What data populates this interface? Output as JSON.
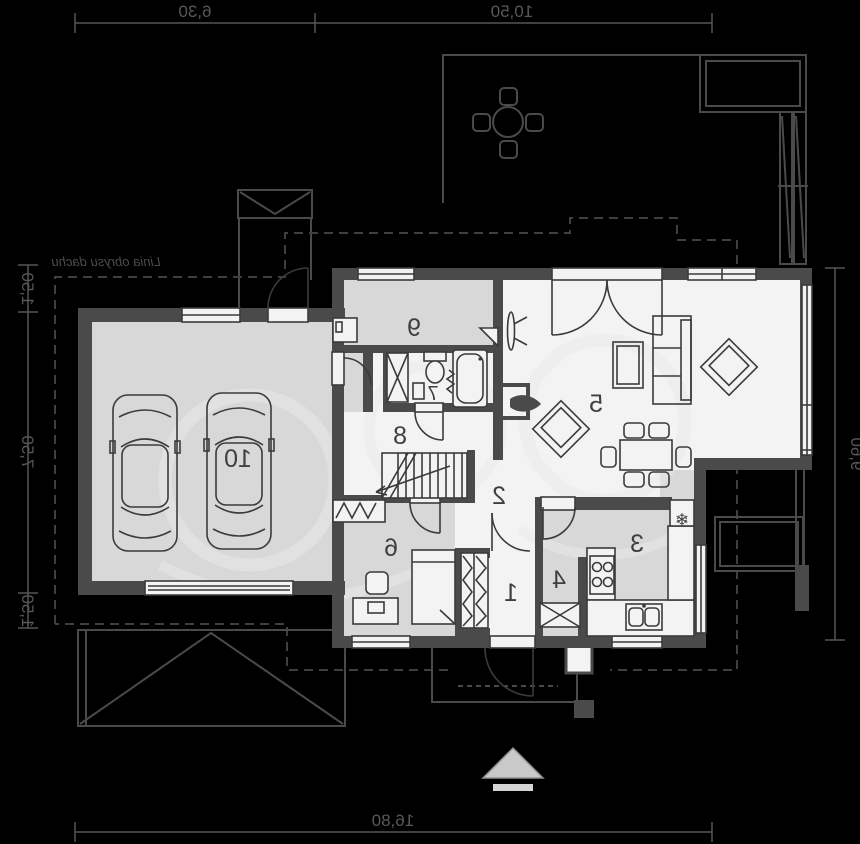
{
  "dimensions": {
    "top_a": "6,30",
    "top_b": "10,50",
    "bottom_total": "16,80",
    "right_total": "9,60",
    "left_a": "1,50",
    "left_b": "7,50",
    "left_c": "1,50"
  },
  "labels": {
    "roof_outline": "Linia obrysu dachu"
  },
  "rooms": {
    "r1": "1",
    "r2": "2",
    "r3": "3",
    "r4": "4",
    "r5": "5",
    "r6": "6",
    "r7": "7",
    "r8": "8",
    "r9": "9",
    "r10": "10"
  },
  "icons": {
    "fridge_snowflake": "❄"
  },
  "colors": {
    "background": "#000000",
    "wall": "#4a4a4a",
    "floor_gray": "#d8d8d8",
    "floor_white": "#f3f3f3",
    "line": "#3b3b3b",
    "dimension": "#585858",
    "watermark": "#e9e9e9",
    "arrow": "#c9c9c9"
  }
}
